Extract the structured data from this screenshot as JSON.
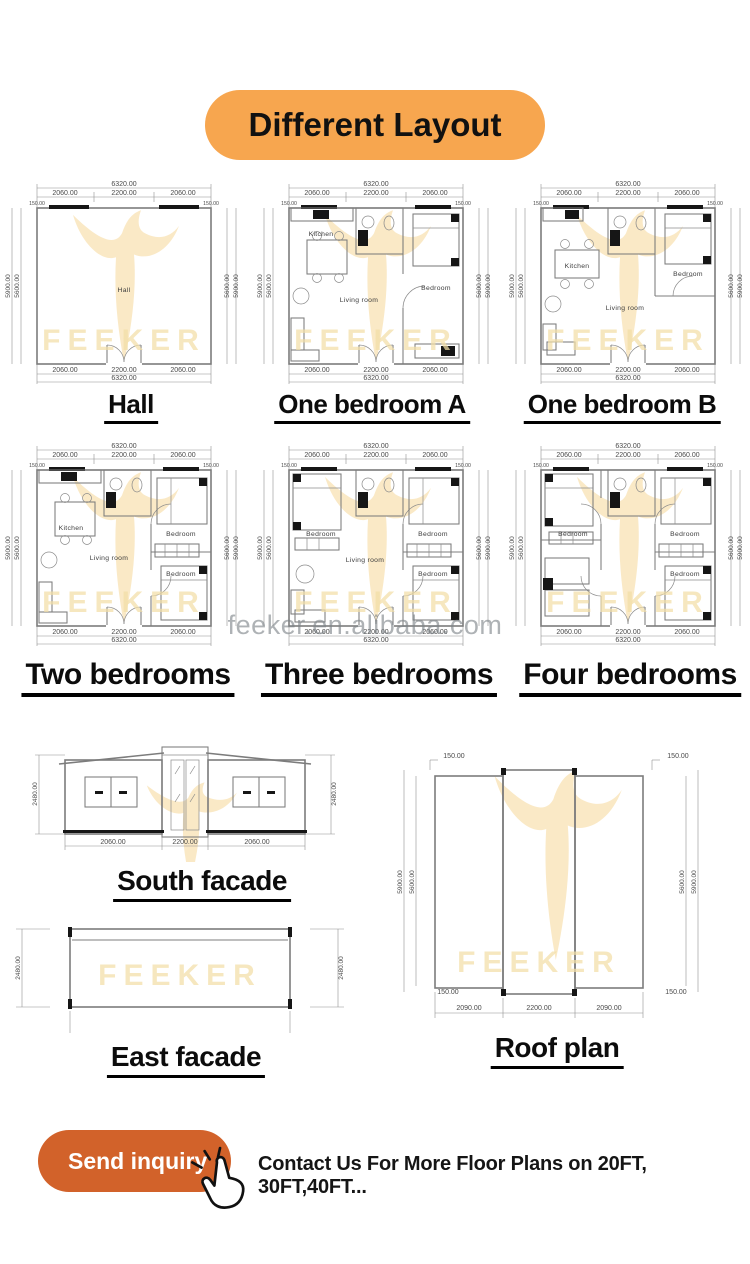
{
  "header": {
    "title": "Different Layout"
  },
  "colors": {
    "banner": "#F7A64F",
    "button": "#D2622A",
    "cad_line": "#7c7c7c",
    "watermark_logo": "#F9E7C0"
  },
  "watermark": {
    "brand": "FEEKER",
    "site": "feeker.en.alibaba.com"
  },
  "plan_dims": {
    "total": "6320.00",
    "seg_side": "2060.00",
    "seg_mid": "2200.00",
    "corner": "150.00",
    "side_outer": "5900.00",
    "side_inner": "5600.00"
  },
  "plans": [
    {
      "title": "Hall",
      "labels": {
        "hall": "Hall"
      }
    },
    {
      "title": "One bedroom A",
      "labels": {
        "kitchen": "Kitchen",
        "living": "Living room",
        "bedroom": "Bedroom"
      }
    },
    {
      "title": "One bedroom B",
      "labels": {
        "kitchen": "Kitchen",
        "living": "Living room",
        "bedroom": "Bedroom"
      }
    },
    {
      "title": "Two bedrooms",
      "labels": {
        "kitchen": "Kitchen",
        "living": "Living room",
        "bedroom1": "Bedroom",
        "bedroom2": "Bedroom"
      }
    },
    {
      "title": "Three bedrooms",
      "labels": {
        "living": "Living room",
        "bedroom1": "Bedroom",
        "bedroom2": "Bedroom",
        "bedroom3": "Bedroom"
      }
    },
    {
      "title": "Four bedrooms",
      "labels": {
        "bedroom1": "Bedroom",
        "bedroom2": "Bedroom",
        "bedroom3": "Bedroom"
      }
    }
  ],
  "south_facade": {
    "title": "South facade",
    "height_dim": "2480.00",
    "bottom_left": "2060.00",
    "bottom_mid": "2200.00",
    "bottom_right": "2060.00"
  },
  "east_facade": {
    "title": "East facade",
    "height_dim": "2480.00"
  },
  "roof_plan": {
    "title": "Roof plan",
    "corner_dim": "150.00",
    "side_outer": "5900.00",
    "side_inner": "5600.00",
    "bottom_left": "2090.00",
    "bottom_mid": "2200.00",
    "bottom_right": "2090.00"
  },
  "footer": {
    "button_label": "Send inquiry",
    "contact_text": "Contact Us For More Floor Plans on 20FT, 30FT,40FT..."
  }
}
